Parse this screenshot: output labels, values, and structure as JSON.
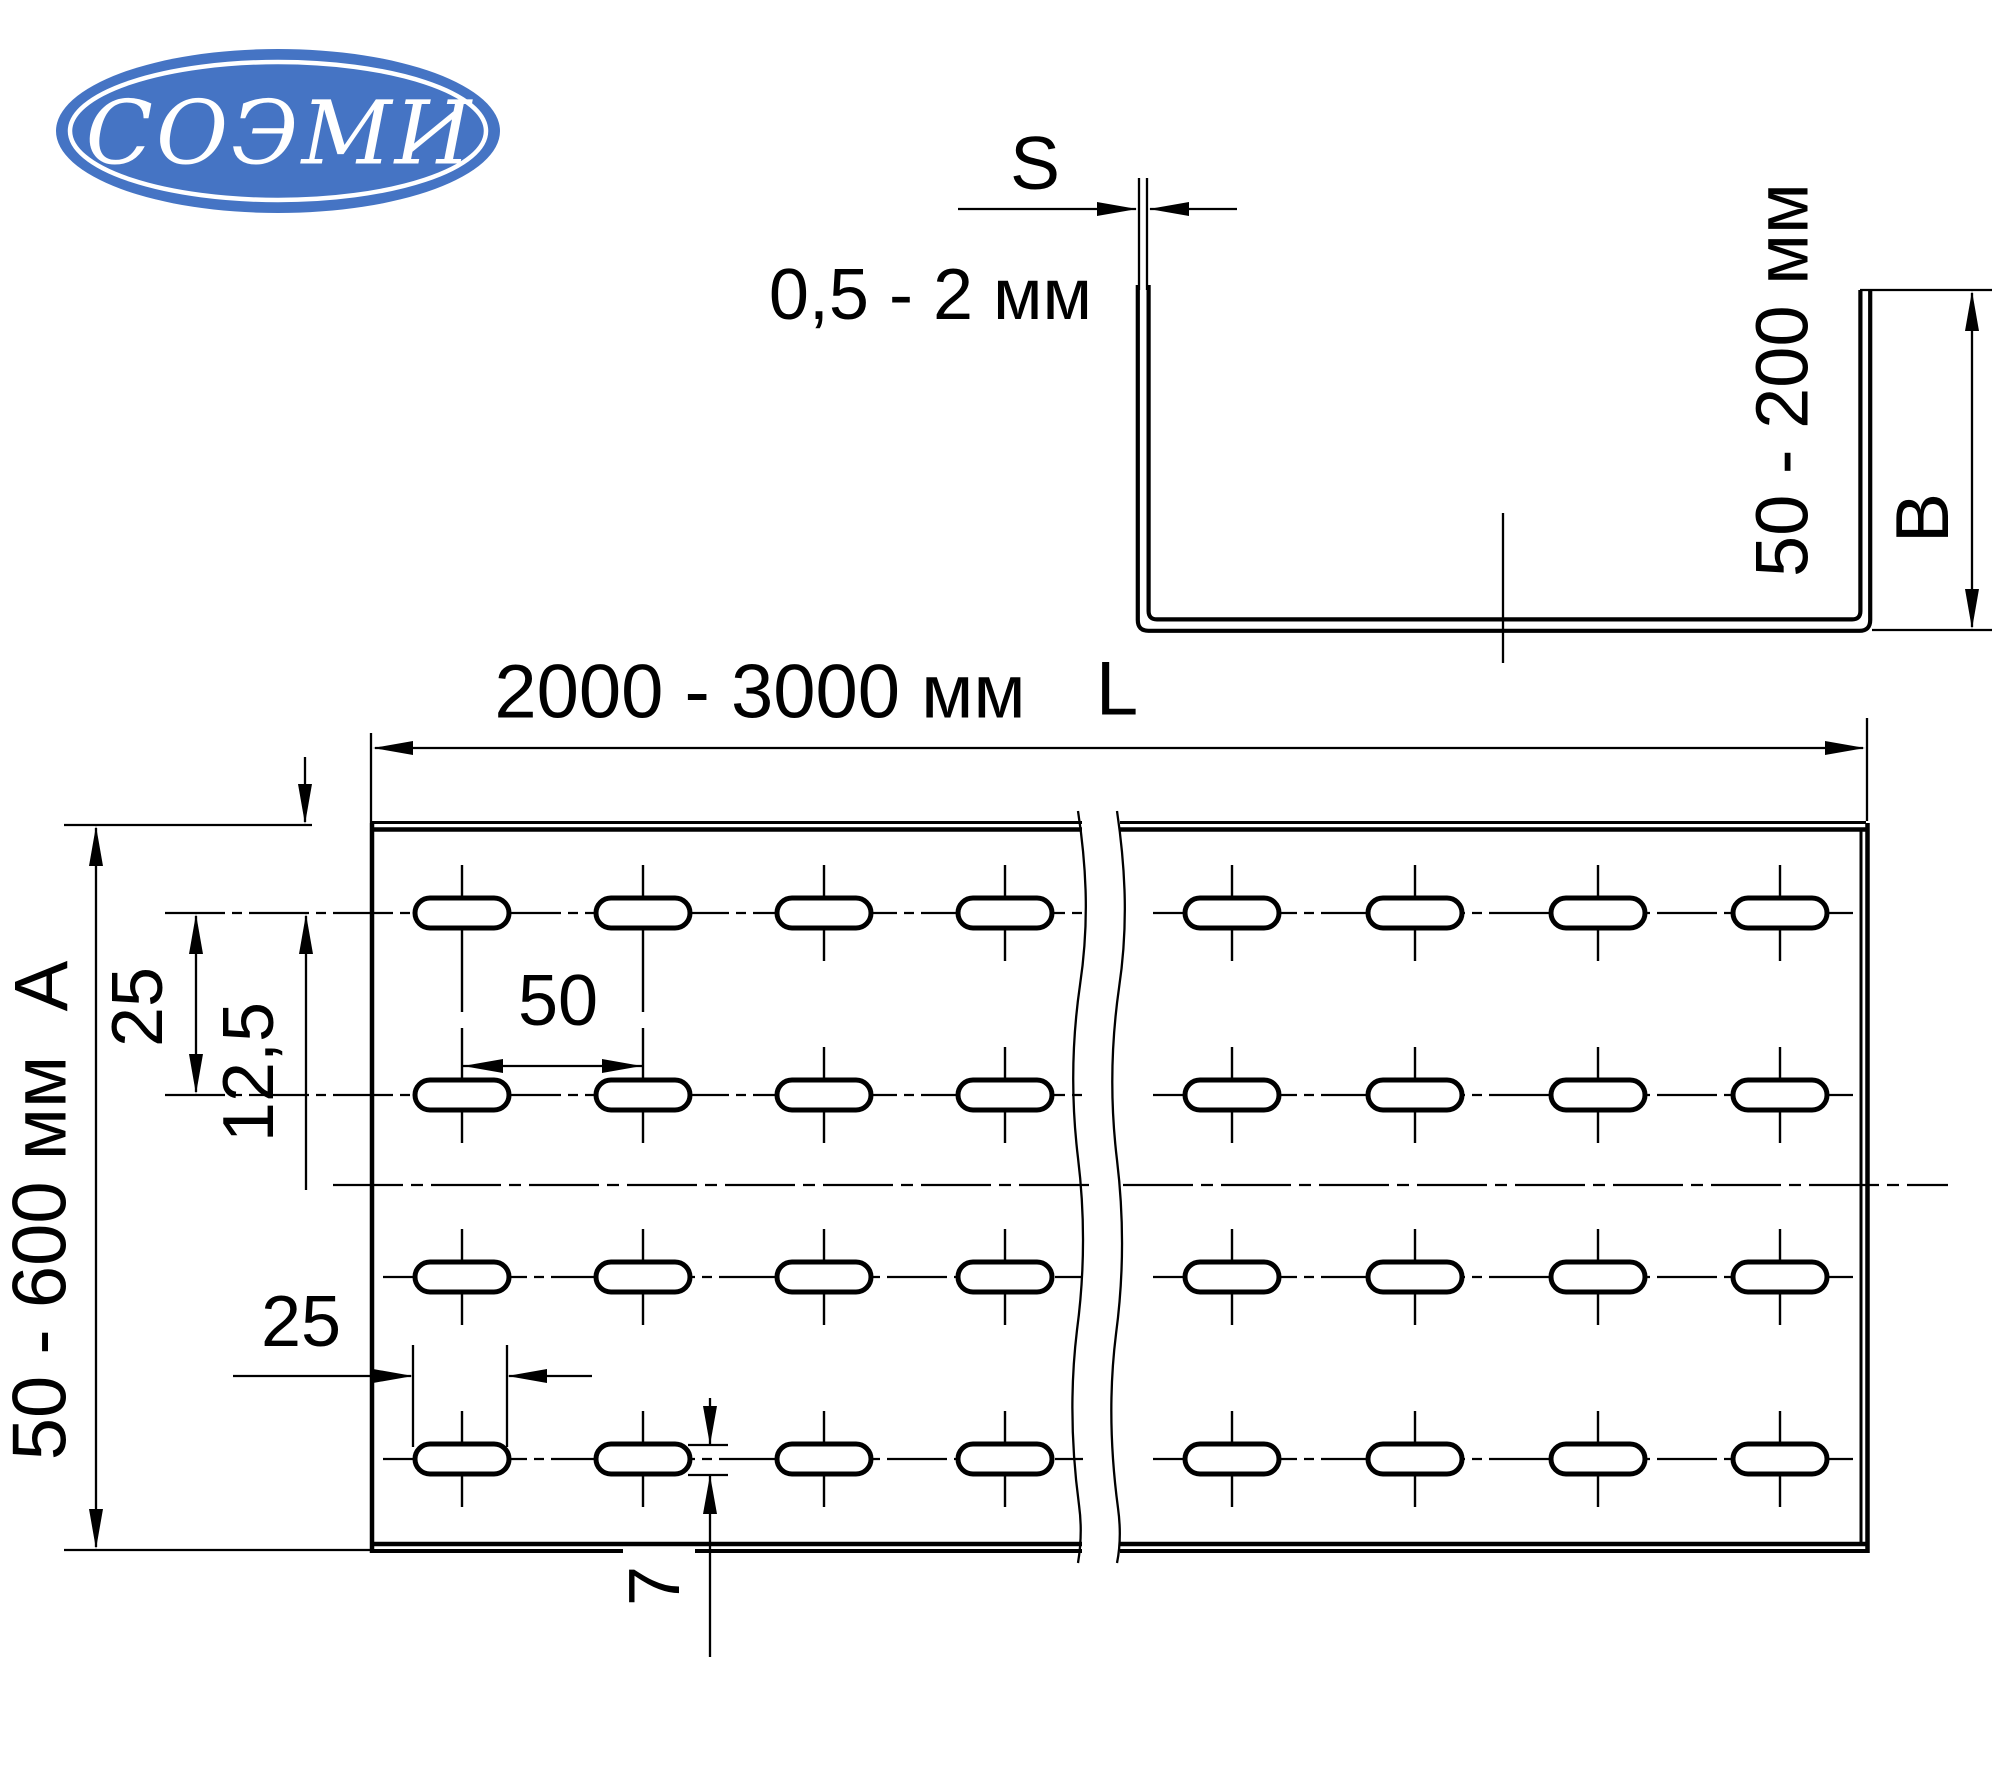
{
  "colors": {
    "line": "#000000",
    "logo_blue": "#4574c4",
    "background": "#ffffff"
  },
  "logo": {
    "text": "СОЭМИ"
  },
  "cross_section": {
    "thickness_letter": "S",
    "thickness_range": "0,5 - 2 мм",
    "flange_height_range": "50 - 200 мм",
    "flange_height_letter": "B"
  },
  "plan_view": {
    "length_range": "2000 - 3000 мм",
    "length_letter": "L",
    "width_range": "50 - 600 мм",
    "width_letter": "A",
    "row_spacing": "25",
    "first_row_offset": "12,5",
    "slot_pitch": "50",
    "slot_length": "25",
    "slot_width": "7"
  }
}
